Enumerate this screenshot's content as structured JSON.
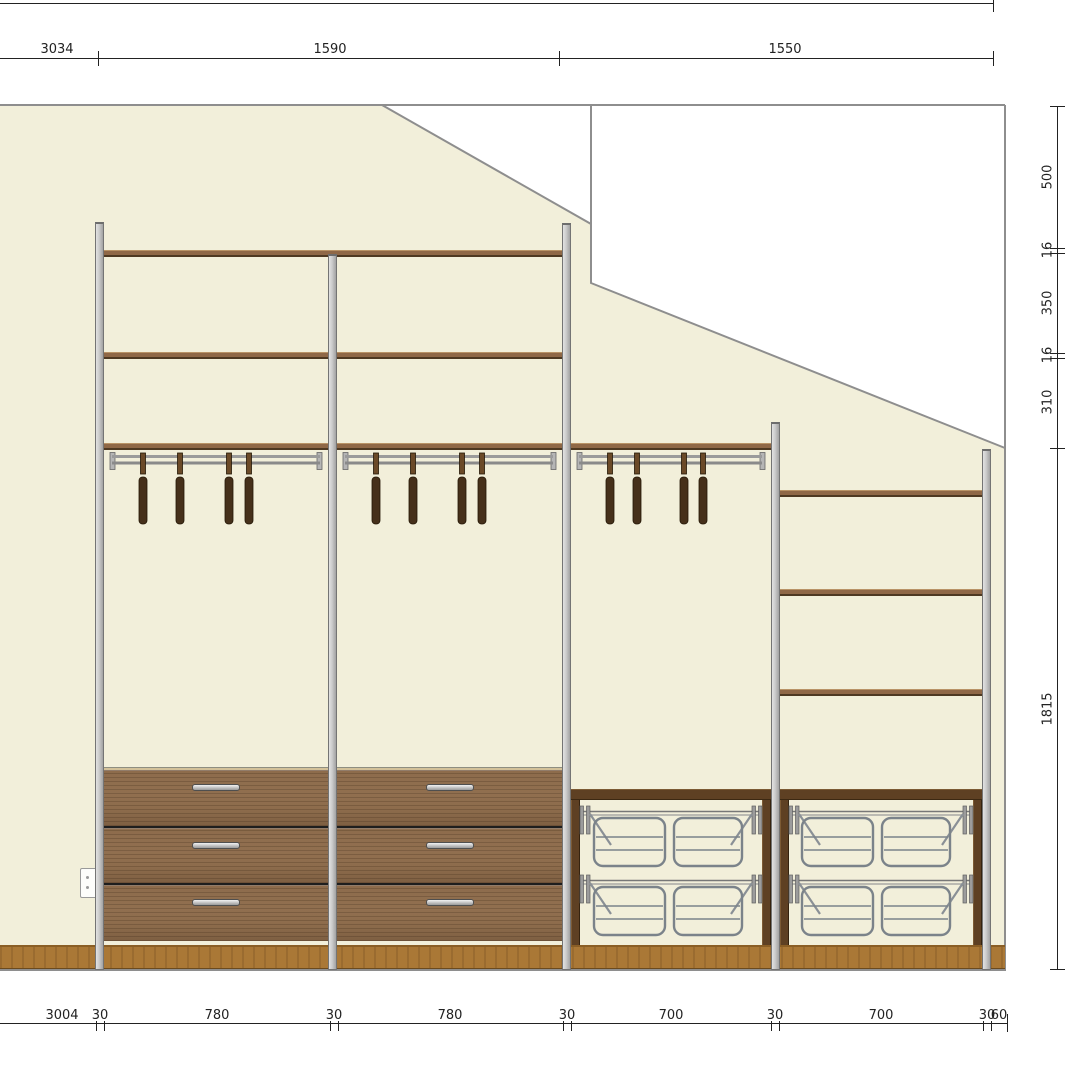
{
  "drawing": {
    "title": "wardrobe-elevation-under-sloped-ceiling",
    "dims": {
      "top": [
        "3034",
        "1590",
        "1550"
      ],
      "right": [
        "500",
        "16",
        "350",
        "16",
        "310",
        "1815"
      ],
      "bottom": [
        "3004",
        "30",
        "780",
        "30",
        "780",
        "30",
        "700",
        "30",
        "700",
        "30",
        "60"
      ]
    },
    "colors": {
      "wall": "#f2efda",
      "outline": "#8e8e8e",
      "dimension_ink": "#222222",
      "post": "#cbcbcb",
      "shelf_wood": "#8f6847",
      "drawer_wood": "#8b6a4c",
      "plinth_wood": "#aa7836",
      "shoe_frame_wood": "#5e4023",
      "wire_metal": "#7b838a",
      "hanger_wood": "#46301a",
      "handle_metal": "#c7c7c7"
    },
    "components": {
      "posts": 5,
      "hanging_sections": 3,
      "hangers_per_section": 4,
      "drawer_sections": 2,
      "drawers_per_section": 3,
      "shoe_rack_sections": 2,
      "wire_racks_per_section": 2,
      "wall_outlet": 1
    }
  }
}
